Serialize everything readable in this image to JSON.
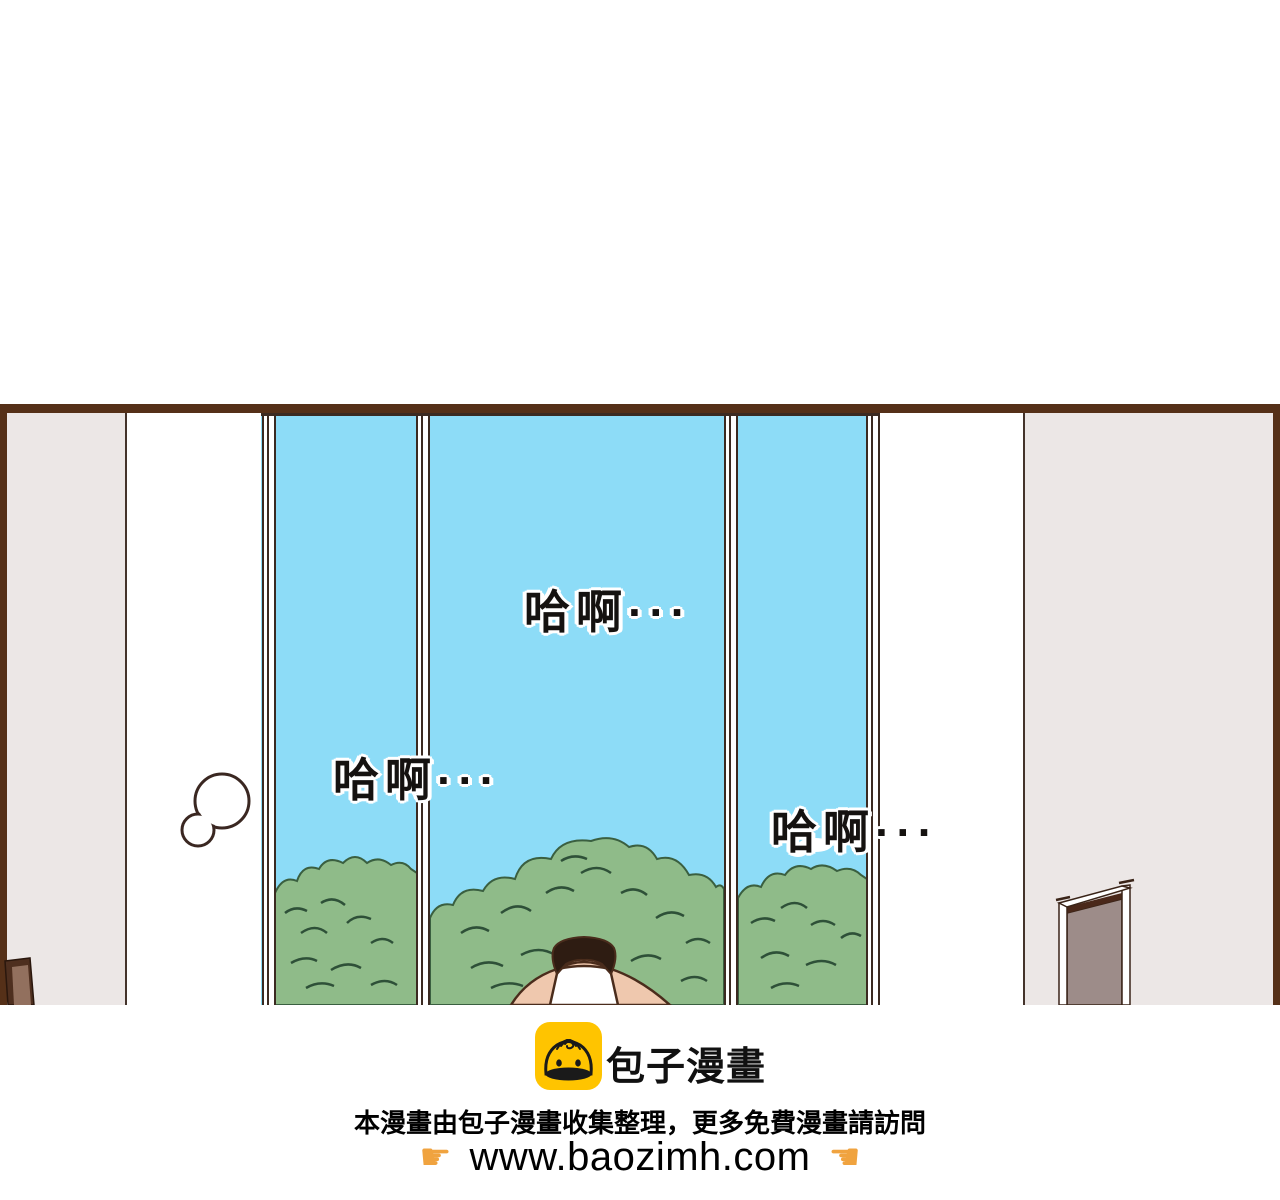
{
  "colors": {
    "page-bg": "#ffffff",
    "panel-border": "#553018",
    "wall-gray": "#ece7e6",
    "wall-white": "#ffffff",
    "wall-line": "#44332b",
    "sky": "#8ddcf7",
    "frame-line": "#3b2a21",
    "tree-fill": "#8fbb89",
    "tree-line": "#3a5f40",
    "tree-dark": "#2e5038",
    "hair": "#2e1c12",
    "skin": "#efc8ae",
    "skin-outline": "#4a2c1c",
    "door-slab": "#9d8c89",
    "door-dark": "#4a281a",
    "bubble-stroke": "#3a2721",
    "brand-yellow": "#ffc400",
    "hand-orange": "#f0a33f",
    "ink": "#151210"
  },
  "panel": {
    "sfx": [
      {
        "text": "哈啊···"
      },
      {
        "text": "哈啊···"
      },
      {
        "text": "哈啊···"
      }
    ]
  },
  "footer": {
    "brand_name": "包子漫畫",
    "notice": "本漫畫由包子漫畫收集整理，更多免費漫畫請訪問",
    "url": "www.baozimh.com",
    "icons": {
      "point_right": "☛",
      "point_left": "☚"
    }
  }
}
